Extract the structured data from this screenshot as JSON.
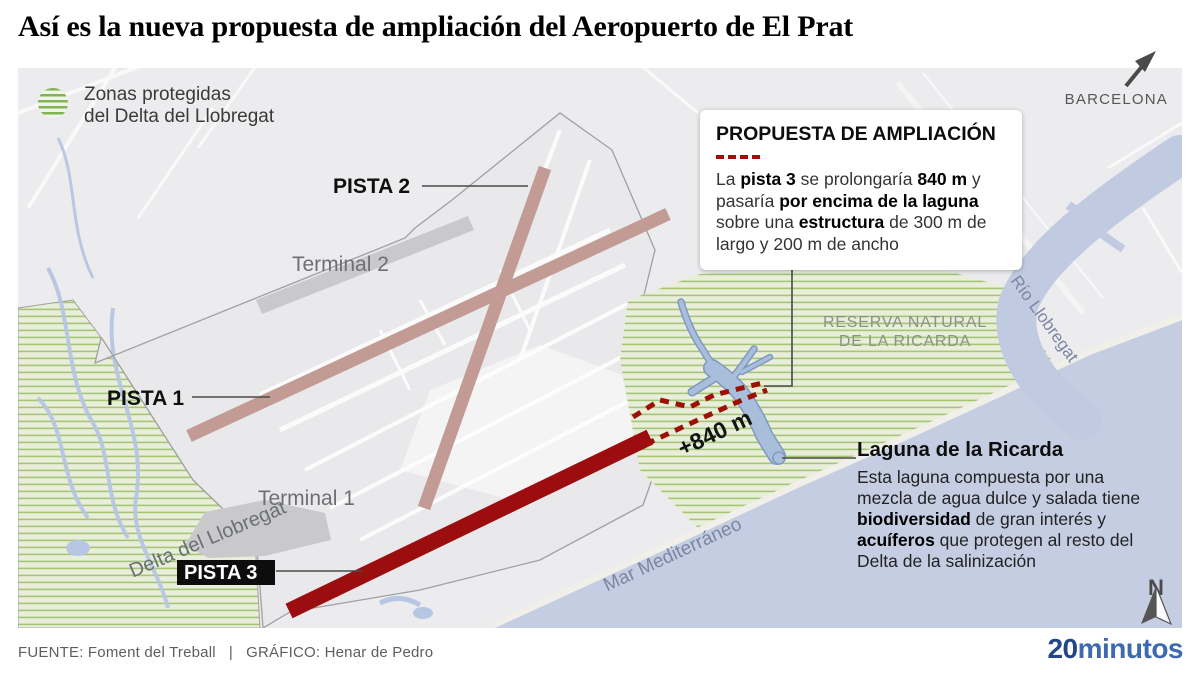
{
  "title": "Así es la nueva propuesta de ampliación del Aeropuerto de El Prat",
  "legend": {
    "line1": "Zonas protegidas",
    "line2": "del Delta del Llobregat"
  },
  "proposal_box": {
    "title": "PROPUESTA DE AMPLIACIÓN",
    "segments": [
      {
        "t": "La ",
        "b": false
      },
      {
        "t": "pista 3",
        "b": true
      },
      {
        "t": " se prolongaría ",
        "b": false
      },
      {
        "t": "840 m",
        "b": true
      },
      {
        "t": " y pasaría ",
        "b": false
      },
      {
        "t": "por encima de la laguna",
        "b": true
      },
      {
        "t": " sobre una ",
        "b": false
      },
      {
        "t": "estructura",
        "b": true
      },
      {
        "t": " de 300 m de largo y 200 m de ancho",
        "b": false
      }
    ]
  },
  "laguna": {
    "title": "Laguna de la Ricarda",
    "segments": [
      {
        "t": "Esta laguna compuesta por una mezcla de agua dulce y salada tiene ",
        "b": false
      },
      {
        "t": "biodiversidad",
        "b": true
      },
      {
        "t": " de gran interés y ",
        "b": false
      },
      {
        "t": "acuíferos",
        "b": true
      },
      {
        "t": " que protegen al resto del Delta de la salinización",
        "b": false
      }
    ]
  },
  "map": {
    "labels": {
      "pista1": "PISTA 1",
      "pista2": "PISTA 2",
      "pista3": "PISTA 3",
      "terminal1": "Terminal 1",
      "terminal2": "Terminal 2",
      "delta": "Delta del Llobregat",
      "mar": "Mar Mediterráneo",
      "rio": "Río Llobregat",
      "reserva_line1": "RESERVA NATURAL",
      "reserva_line2": "DE LA RICARDA",
      "extension": "+840 m",
      "barcelona": "BARCELONA",
      "north": "N"
    }
  },
  "footer": {
    "source": "FUENTE: Foment del Treball",
    "separator": "|",
    "credit": "GRÁFICO: Henar de Pedro",
    "logo_part1": "20",
    "logo_part2": "minutos"
  },
  "colors": {
    "runway_existing": "#c29b95",
    "runway_proposed": "#9c0d10",
    "protected_hatch_green": "#9dc169",
    "sea_blue": "#c4cde2",
    "lagoon_blue": "#a9bedb",
    "logo_blue_dark": "#23458a",
    "logo_blue_light": "#3d69ae"
  }
}
